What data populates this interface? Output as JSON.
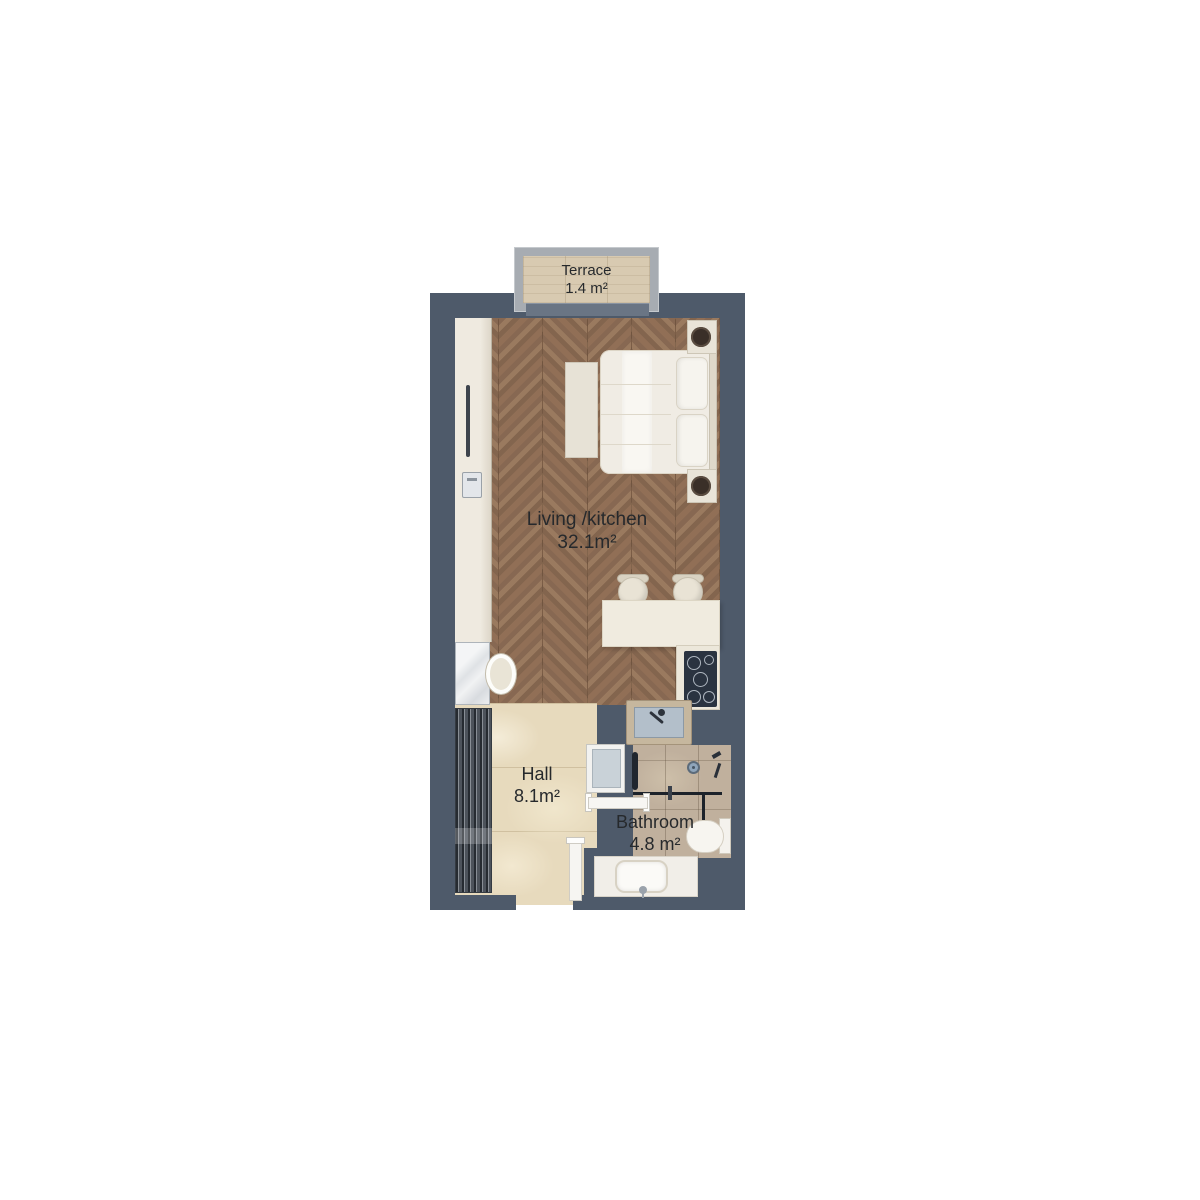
{
  "rooms": {
    "terrace": {
      "label": "Terrace",
      "area": "1.4 m²"
    },
    "living": {
      "label": "Living /kitchen",
      "area": "32.1m²"
    },
    "hall": {
      "label": "Hall",
      "area": "8.1m²"
    },
    "bathroom": {
      "label": "Bathroom",
      "area": "4.8 m²"
    }
  },
  "colors": {
    "background": "#ffffff",
    "wall": "#4e5a6a",
    "terrace_wall": "#a7acb2",
    "wood_light": "#d8cab1",
    "wood_floor": "#8f7157",
    "marble_floor": "#e7dabd",
    "tile_floor": "#c0b09d",
    "furniture": "#ece7db",
    "label_text": "#26292c"
  }
}
